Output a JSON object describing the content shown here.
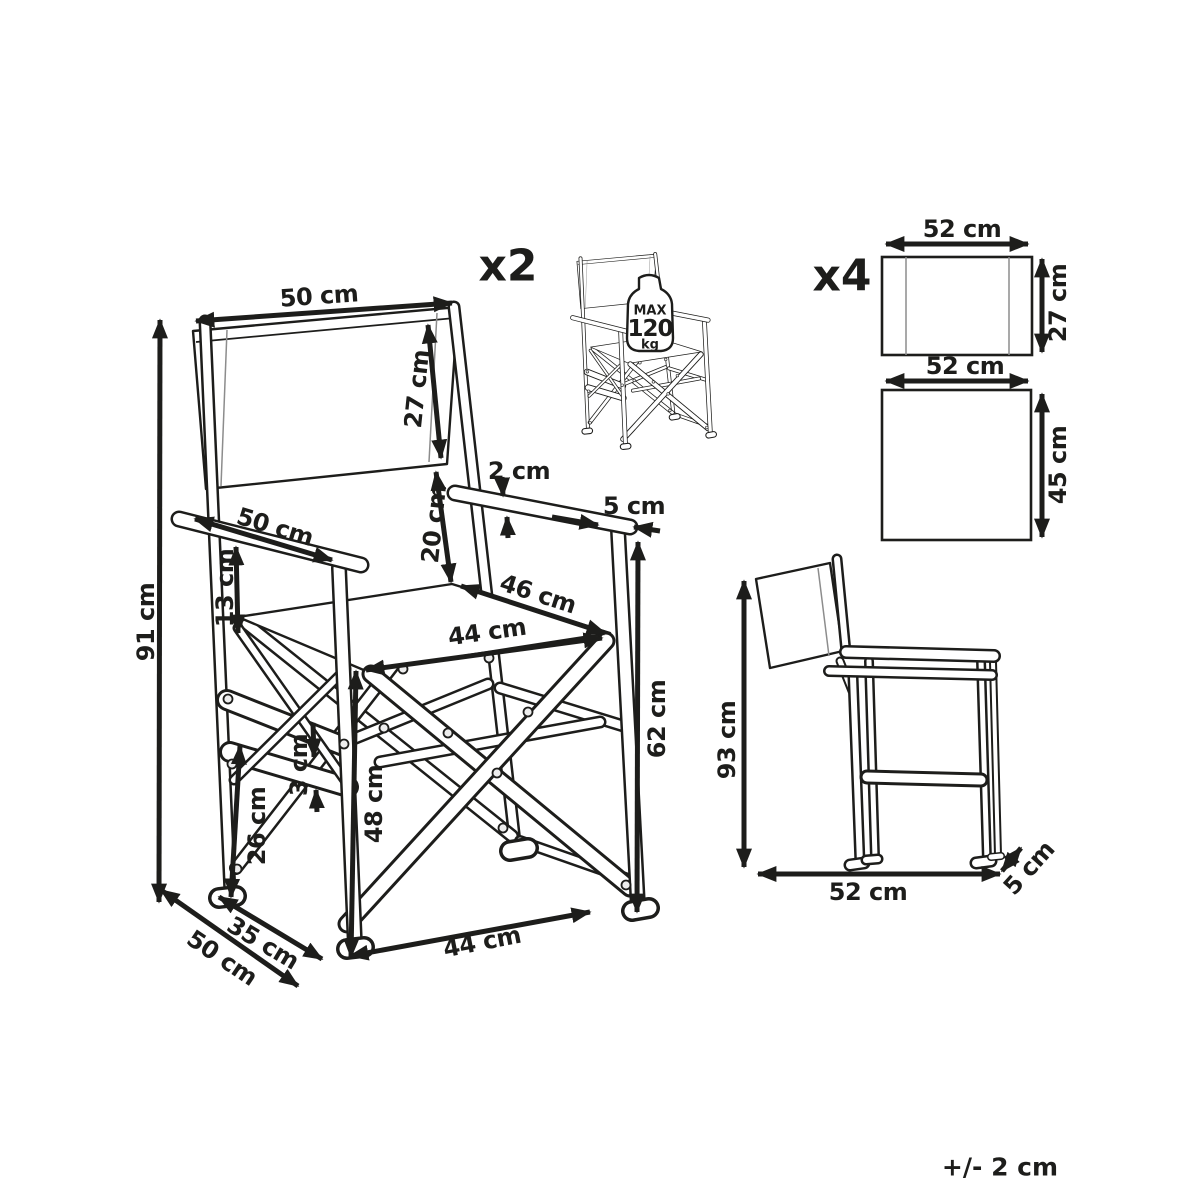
{
  "tolerance_note": "+/- 2 cm",
  "quantities": {
    "chairs": "x2",
    "panels": "x4"
  },
  "max_load": {
    "label": "MAX",
    "value": "120",
    "unit": "kg"
  },
  "front_view": {
    "backrest_width": "50 cm",
    "backrest_fabric_height": "27 cm",
    "total_height": "91 cm",
    "armrest_length": "50 cm",
    "backrest_to_armrest_gap": "13 cm",
    "armrest_thickness": "2 cm",
    "armrest_end_width": "5 cm",
    "backrest_bottom_to_seat": "20 cm",
    "seat_depth": "46 cm",
    "seat_width": "44 cm",
    "armrest_height": "62 cm",
    "seat_height": "48 cm",
    "stretcher_thickness": "3 cm",
    "stretcher_height": "26 cm",
    "base_inner_depth": "35 cm",
    "base_depth": "50 cm",
    "base_width": "44 cm"
  },
  "side_view": {
    "total_height": "93 cm",
    "depth": "52 cm",
    "frame_thickness": "5 cm"
  },
  "fabric_panels": {
    "backrest_panel": {
      "width": "52 cm",
      "height": "27 cm"
    },
    "seat_panel": {
      "width": "52 cm",
      "height": "45 cm"
    }
  }
}
